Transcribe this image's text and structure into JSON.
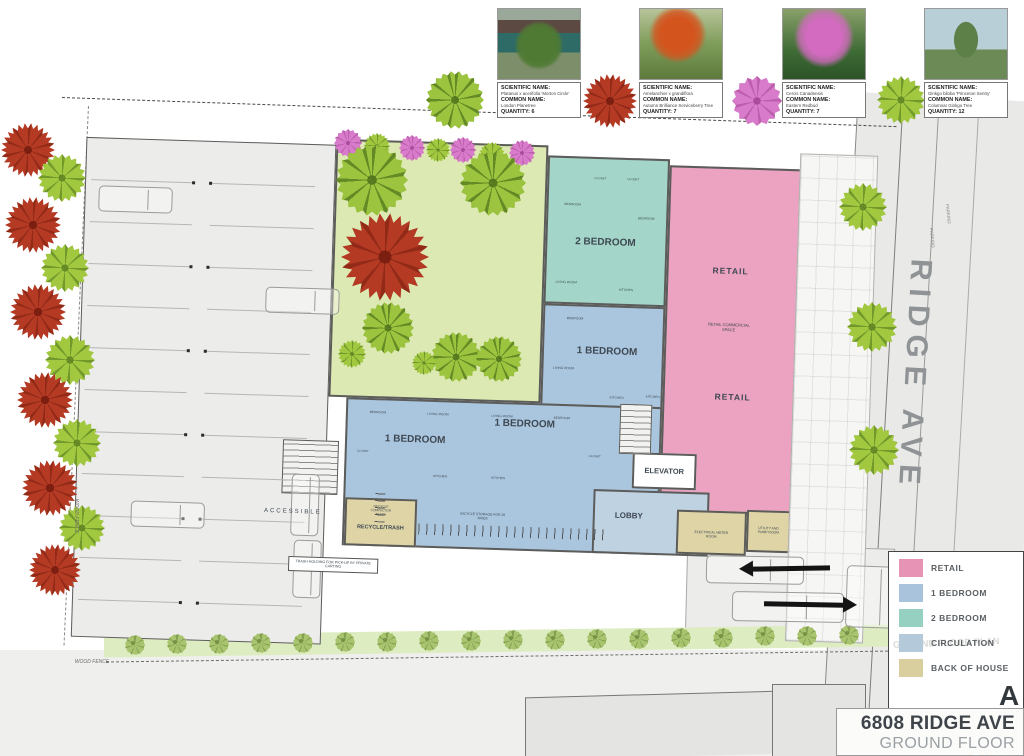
{
  "cards": {
    "fields": {
      "scientific": "SCIENTIFIC NAME:",
      "common": "COMMON NAME:",
      "quantity": "QUANTITY:"
    },
    "items": [
      {
        "scientific": "Platanus x acerifolia 'Morton Circle'",
        "common": "London Planetree",
        "quantity": "6"
      },
      {
        "scientific": "Amelanchier x grandiflora",
        "common": "Autumn Brilliance Serviceberry Tree",
        "quantity": "7"
      },
      {
        "scientific": "Cercis Canadensis",
        "common": "Eastern Redbud",
        "quantity": "7"
      },
      {
        "scientific": "Ginkgo biloba 'Princeton Sentry'",
        "common": "Columnar Ginkgo Tree",
        "quantity": "12"
      }
    ]
  },
  "legend": {
    "items": [
      {
        "label": "RETAIL",
        "color": "#e793b6"
      },
      {
        "label": "1 BEDROOM",
        "color": "#a9c3dc"
      },
      {
        "label": "2 BEDROOM",
        "color": "#96d0c0"
      },
      {
        "label": "CIRCULATION",
        "color": "#b4c9da"
      },
      {
        "label": "BACK OF HOUSE",
        "color": "#d9cf9e"
      }
    ],
    "watermark": "GROUND FLOOR PLAN",
    "corner_letter": "A"
  },
  "title_block": {
    "address": "6808 RIDGE AVE",
    "sheet": "GROUND FLOOR PLAN"
  },
  "street": {
    "name": "RIDGE AVE"
  },
  "colors": {
    "retail": "#eba3c1",
    "one_bedroom": "#aac6df",
    "two_bedroom": "#a3d6c9",
    "circulation": "#bfd2e2",
    "back_of_house": "#ded4a6",
    "courtyard": "#dce9b2",
    "tree_green": "#9cc43e",
    "tree_red": "#b53a24",
    "tree_pink": "#d77bca"
  },
  "plan": {
    "labels": [
      {
        "t": "2 BEDROOM",
        "x": 552,
        "y": 138,
        "s": 10,
        "b": 1
      },
      {
        "t": "1 BEDROOM",
        "x": 557,
        "y": 247,
        "s": 10,
        "b": 1
      },
      {
        "t": "1 BEDROOM",
        "x": 368,
        "y": 341,
        "s": 10,
        "b": 1
      },
      {
        "t": "1 BEDROOM",
        "x": 477,
        "y": 322,
        "s": 10,
        "b": 1
      },
      {
        "t": "RETAIL",
        "x": 678,
        "y": 162,
        "s": 8.5,
        "b": 1,
        "ls": 1
      },
      {
        "t": "RETAIL COMMERCIAL SPACE",
        "x": 678,
        "y": 218,
        "s": 4,
        "w": 46,
        "wrap": 1
      },
      {
        "t": "RETAIL",
        "x": 684,
        "y": 288,
        "s": 8.5,
        "b": 1,
        "ls": 1
      },
      {
        "t": "ELEVATOR",
        "x": 618,
        "y": 364,
        "s": 7.5,
        "b": 1
      },
      {
        "t": "LOBBY",
        "x": 584,
        "y": 410,
        "s": 8,
        "b": 1
      },
      {
        "t": "RECYCLE/TRASH",
        "x": 336,
        "y": 430,
        "s": 5.5,
        "b": 1
      },
      {
        "t": "RECYCLE COMPACTOR TRASH",
        "x": 336,
        "y": 412,
        "s": 3.2,
        "w": 32,
        "wrap": 1
      },
      {
        "t": "ELECTRICAL METER ROOM",
        "x": 667,
        "y": 426,
        "s": 3.4,
        "w": 34,
        "wrap": 1
      },
      {
        "t": "UTILITY AND PUMP ROOM",
        "x": 724,
        "y": 420,
        "s": 3.4,
        "w": 30,
        "wrap": 1
      },
      {
        "t": "BICYCLE STORAGE FOR 28 BIKES",
        "x": 438,
        "y": 415,
        "s": 3.4,
        "w": 46,
        "wrap": 1
      },
      {
        "t": "ACCESSIBLE",
        "x": 248,
        "y": 417,
        "s": 6,
        "ls": 2
      },
      {
        "t": "TRASH HOLDING FOR PICK-UP BY PRIVATE CARTING",
        "x": 290,
        "y": 468,
        "s": 3.6,
        "w": 82,
        "box": 1
      },
      {
        "t": "BEDROOM",
        "x": 518,
        "y": 100,
        "s": 3.2
      },
      {
        "t": "BEDROOM",
        "x": 592,
        "y": 112,
        "s": 3.2
      },
      {
        "t": "CLOSET",
        "x": 545,
        "y": 74,
        "s": 3
      },
      {
        "t": "CLOSET",
        "x": 578,
        "y": 74,
        "s": 3
      },
      {
        "t": "LIVING ROOM",
        "x": 514,
        "y": 178,
        "s": 3.2
      },
      {
        "t": "KITCHEN",
        "x": 574,
        "y": 184,
        "s": 3.2
      },
      {
        "t": "BEDROOM",
        "x": 524,
        "y": 214,
        "s": 3.2
      },
      {
        "t": "LIVING ROOM",
        "x": 514,
        "y": 264,
        "s": 3.2
      },
      {
        "t": "KITCHEN",
        "x": 568,
        "y": 292,
        "s": 3.2
      },
      {
        "t": "BEDROOM",
        "x": 330,
        "y": 314,
        "s": 3.2
      },
      {
        "t": "LIVING ROOM",
        "x": 390,
        "y": 314,
        "s": 3.2
      },
      {
        "t": "LIVING ROOM",
        "x": 454,
        "y": 314,
        "s": 3.2
      },
      {
        "t": "BEDROOM",
        "x": 514,
        "y": 314,
        "s": 3.2
      },
      {
        "t": "CLOSET",
        "x": 316,
        "y": 354,
        "s": 3
      },
      {
        "t": "KITCHEN",
        "x": 394,
        "y": 376,
        "s": 3.2
      },
      {
        "t": "KITCHEN",
        "x": 452,
        "y": 376,
        "s": 3.2
      },
      {
        "t": "CLOSET",
        "x": 548,
        "y": 352,
        "s": 3
      },
      {
        "t": "KITCHEN",
        "x": 604,
        "y": 290,
        "s": 3.2
      }
    ]
  },
  "site": {
    "labels": [
      {
        "t": "WOOD FENCE",
        "x": 92,
        "y": 662,
        "s": 5,
        "i": 1
      },
      {
        "t": "WOOD FENCE",
        "x": 76,
        "y": 516,
        "s": 5,
        "i": 1,
        "r": 90
      },
      {
        "t": "PARKING",
        "x": 948,
        "y": 214,
        "s": 4.5,
        "r": 84,
        "c": "#8a8a88"
      },
      {
        "t": "PARKING",
        "x": 932,
        "y": 238,
        "s": 4.5,
        "r": 84,
        "c": "#8a8a88"
      }
    ]
  },
  "trees": [
    {
      "k": "r",
      "x": 28,
      "y": 150,
      "r": 27
    },
    {
      "k": "g",
      "x": 62,
      "y": 178,
      "r": 24
    },
    {
      "k": "r",
      "x": 33,
      "y": 225,
      "r": 28
    },
    {
      "k": "g",
      "x": 65,
      "y": 268,
      "r": 24
    },
    {
      "k": "r",
      "x": 38,
      "y": 312,
      "r": 28
    },
    {
      "k": "g",
      "x": 70,
      "y": 360,
      "r": 25
    },
    {
      "k": "r",
      "x": 45,
      "y": 400,
      "r": 28
    },
    {
      "k": "g",
      "x": 77,
      "y": 443,
      "r": 24
    },
    {
      "k": "r",
      "x": 50,
      "y": 488,
      "r": 28
    },
    {
      "k": "g",
      "x": 82,
      "y": 528,
      "r": 23
    },
    {
      "k": "r",
      "x": 55,
      "y": 570,
      "r": 26
    },
    {
      "k": "p",
      "x": 348,
      "y": 143,
      "r": 14
    },
    {
      "k": "g",
      "x": 377,
      "y": 146,
      "r": 13
    },
    {
      "k": "p",
      "x": 412,
      "y": 148,
      "r": 13
    },
    {
      "k": "g",
      "x": 438,
      "y": 150,
      "r": 12
    },
    {
      "k": "p",
      "x": 463,
      "y": 150,
      "r": 13
    },
    {
      "k": "g",
      "x": 492,
      "y": 155,
      "r": 13
    },
    {
      "k": "p",
      "x": 522,
      "y": 153,
      "r": 13
    },
    {
      "k": "G",
      "x": 372,
      "y": 180,
      "r": 36
    },
    {
      "k": "G",
      "x": 493,
      "y": 183,
      "r": 33
    },
    {
      "k": "r",
      "x": 385,
      "y": 257,
      "r": 44
    },
    {
      "k": "G",
      "x": 388,
      "y": 328,
      "r": 26
    },
    {
      "k": "g",
      "x": 352,
      "y": 354,
      "r": 14
    },
    {
      "k": "G",
      "x": 456,
      "y": 357,
      "r": 25
    },
    {
      "k": "G",
      "x": 499,
      "y": 359,
      "r": 23
    },
    {
      "k": "g",
      "x": 424,
      "y": 363,
      "r": 12
    },
    {
      "k": "G",
      "x": 455,
      "y": 100,
      "r": 29
    },
    {
      "k": "r",
      "x": 610,
      "y": 101,
      "r": 27
    },
    {
      "k": "p",
      "x": 757,
      "y": 101,
      "r": 25
    },
    {
      "k": "g",
      "x": 901,
      "y": 100,
      "r": 24
    },
    {
      "k": "g",
      "x": 863,
      "y": 207,
      "r": 24
    },
    {
      "k": "g",
      "x": 872,
      "y": 327,
      "r": 25
    },
    {
      "k": "g",
      "x": 874,
      "y": 450,
      "r": 25
    },
    {
      "k": "b",
      "x": 135,
      "y": 645,
      "r": 10
    },
    {
      "k": "b",
      "x": 177,
      "y": 644,
      "r": 10
    },
    {
      "k": "b",
      "x": 219,
      "y": 644,
      "r": 10
    },
    {
      "k": "b",
      "x": 261,
      "y": 643,
      "r": 10
    },
    {
      "k": "b",
      "x": 303,
      "y": 643,
      "r": 10
    },
    {
      "k": "b",
      "x": 345,
      "y": 642,
      "r": 10
    },
    {
      "k": "b",
      "x": 387,
      "y": 642,
      "r": 10
    },
    {
      "k": "b",
      "x": 429,
      "y": 641,
      "r": 10
    },
    {
      "k": "b",
      "x": 471,
      "y": 641,
      "r": 10
    },
    {
      "k": "b",
      "x": 513,
      "y": 640,
      "r": 10
    },
    {
      "k": "b",
      "x": 555,
      "y": 640,
      "r": 10
    },
    {
      "k": "b",
      "x": 597,
      "y": 639,
      "r": 10
    },
    {
      "k": "b",
      "x": 639,
      "y": 639,
      "r": 10
    },
    {
      "k": "b",
      "x": 681,
      "y": 638,
      "r": 10
    },
    {
      "k": "b",
      "x": 723,
      "y": 638,
      "r": 10
    },
    {
      "k": "b",
      "x": 765,
      "y": 636,
      "r": 10
    },
    {
      "k": "b",
      "x": 807,
      "y": 636,
      "r": 10
    },
    {
      "k": "b",
      "x": 849,
      "y": 635,
      "r": 10
    }
  ]
}
